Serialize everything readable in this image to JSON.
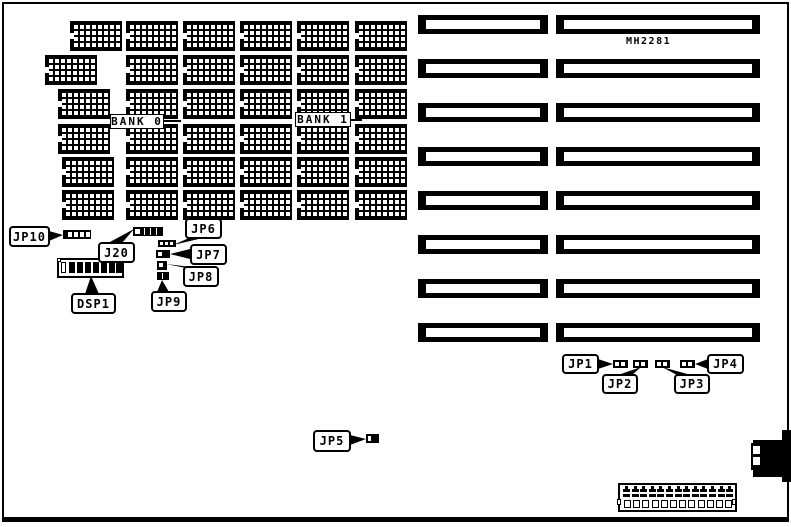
{
  "diagram": {
    "board_id": "MH2281",
    "memory": {
      "bank0_label": "BANK 0",
      "bank1_label": "BANK 1"
    },
    "callouts": {
      "jp1": "JP1",
      "jp2": "JP2",
      "jp3": "JP3",
      "jp4": "JP4",
      "jp5": "JP5",
      "jp6": "JP6",
      "jp7": "JP7",
      "jp8": "JP8",
      "jp9": "JP9",
      "jp10": "JP10",
      "j20": "J20",
      "dsp1": "DSP1"
    },
    "colors": {
      "ink": "#000000",
      "paper": "#ffffff"
    }
  }
}
